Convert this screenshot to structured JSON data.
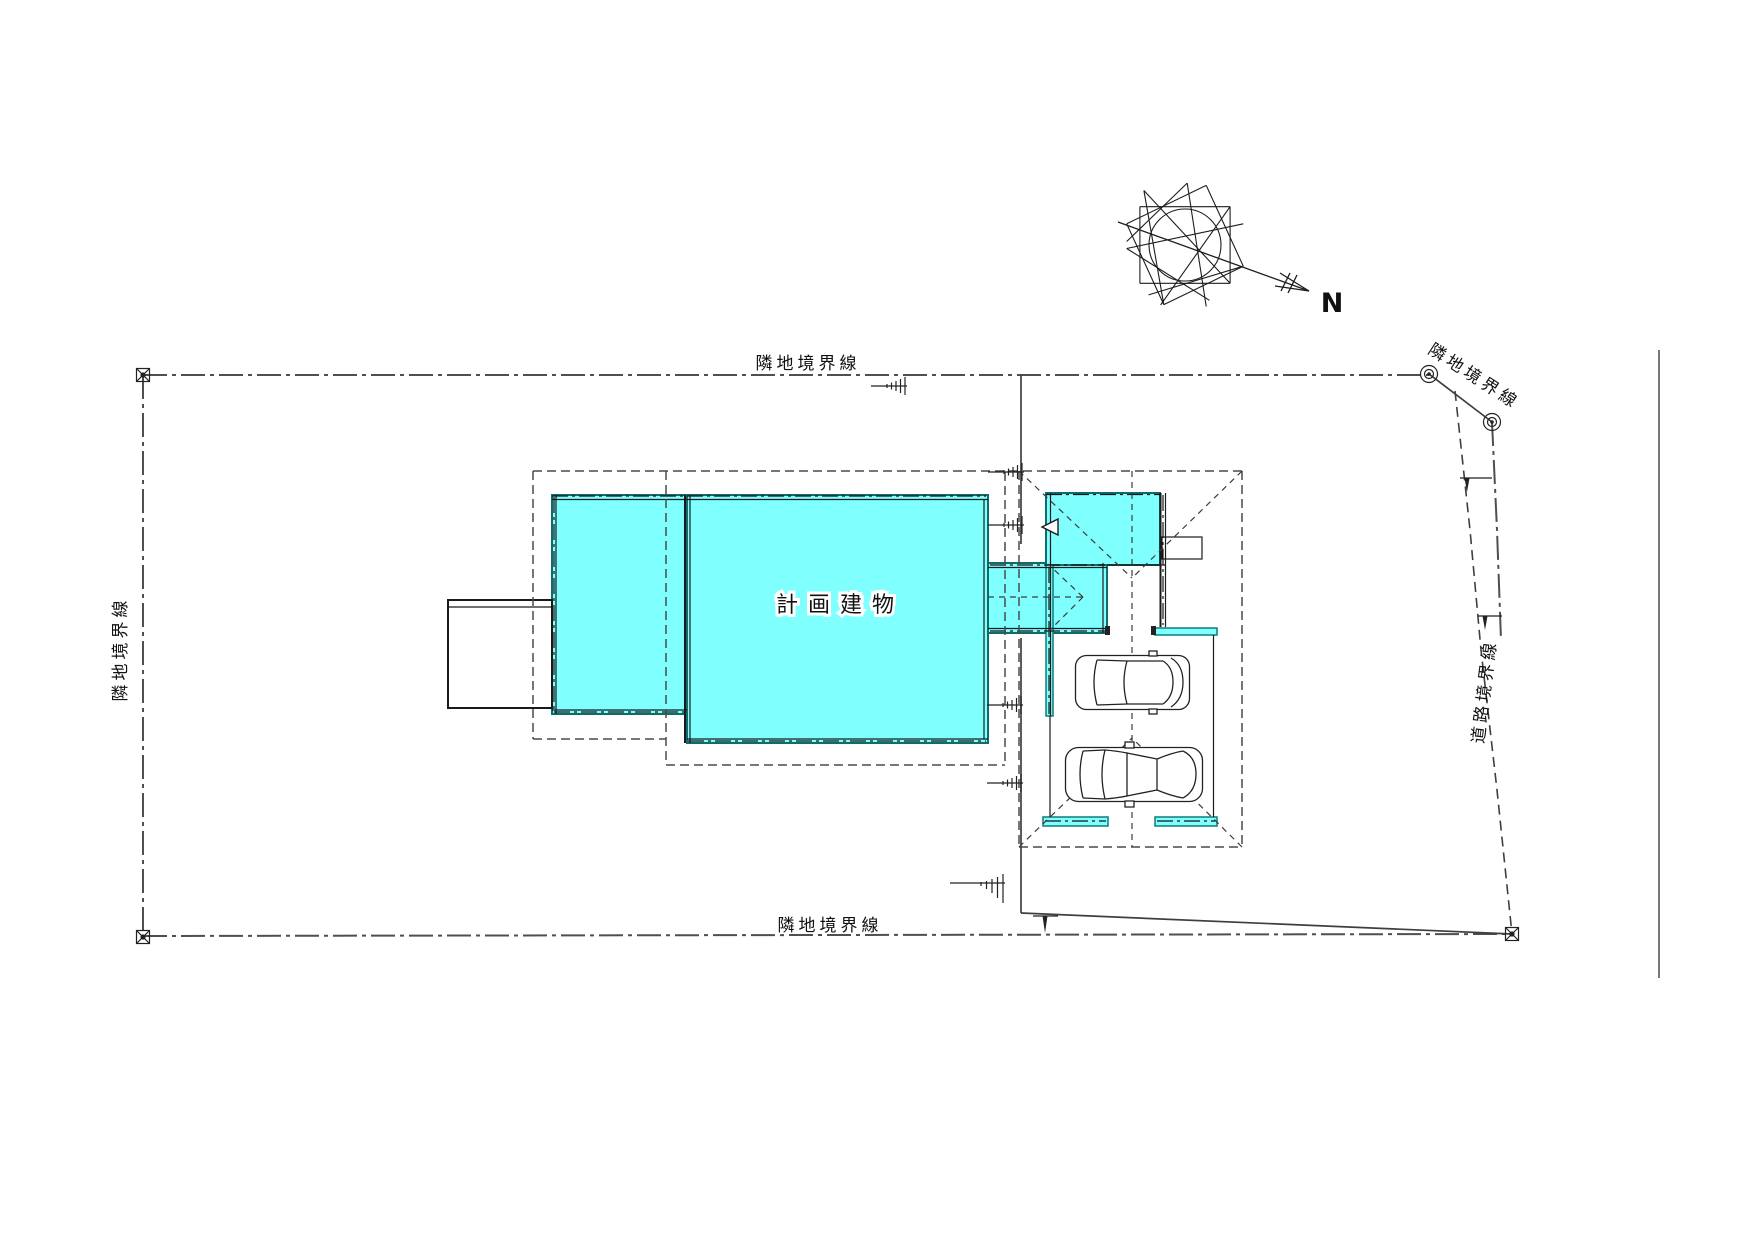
{
  "drawing": {
    "type": "site-plan",
    "building_label": "計画建物",
    "north_label": "N",
    "boundaries": {
      "top": "隣地境界線",
      "left": "隣地境界線",
      "bottom": "隣地境界線",
      "upper_right": "隣地境界線",
      "road": "道路境界線"
    },
    "colors": {
      "building_fill": "#80FFFF",
      "wall_line": "#1A1A1A",
      "strip_outline": "#0E7C7C",
      "boundary_line": "#4F4F4F",
      "roof_dash_line": "#4A4A4A",
      "background": "#FFFFFF"
    },
    "objects": {
      "compass_rose": "8-point star with north arrow",
      "cars": 2,
      "boundary_corner_markers": 3,
      "boundary_pin_markers": 2,
      "ground_level_marks": 6,
      "fence_marks": 3
    }
  }
}
